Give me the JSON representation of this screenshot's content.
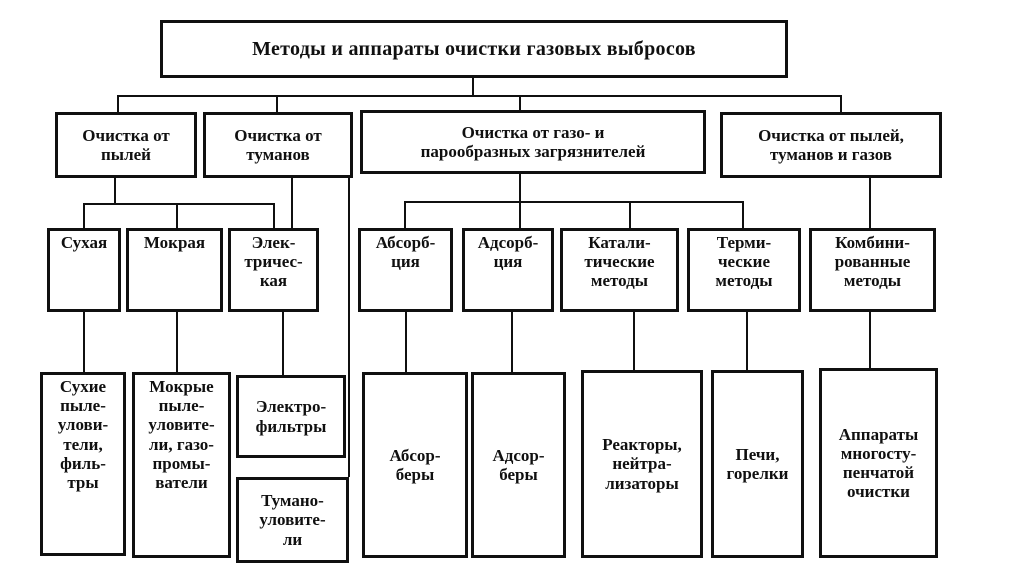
{
  "colors": {
    "ink": "#101010",
    "background": "#ffffff"
  },
  "nodes": {
    "root": {
      "label": "Методы и аппараты очистки газовых выбросов"
    },
    "dust": {
      "label": "Очистка от\nпылей"
    },
    "fog": {
      "label": "Очистка от\nтуманов"
    },
    "gas_vapor": {
      "label": "Очистка от газо- и\nпарообразных загрязнителей"
    },
    "dust_fog_gas": {
      "label": "Очистка от пылей,\nтуманов и газов"
    },
    "dry": {
      "label": "Сухая"
    },
    "wet": {
      "label": "Мокрая"
    },
    "electric": {
      "label": "Элек-\nтричес-\nкая"
    },
    "absorption": {
      "label": "Абсорб-\nция"
    },
    "adsorption": {
      "label": "Адсорб-\nция"
    },
    "catalytic": {
      "label": "Катали-\nтические\nметоды"
    },
    "thermal": {
      "label": "Терми-\nческие\nметоды"
    },
    "combined": {
      "label": "Комбини-\nрованные\nметоды"
    },
    "dry_collectors": {
      "label": "Сухие\nпыле-\nулови-\nтели,\nфиль-\nтры"
    },
    "wet_collectors": {
      "label": "Мокрые\nпыле-\nуловите-\nли, газо-\nпромы-\nватели"
    },
    "electrofilters": {
      "label": "Электро-\nфильтры"
    },
    "mist_collectors": {
      "label": "Тумано-\nуловите-\nли"
    },
    "absorbers": {
      "label": "Абсор-\nберы"
    },
    "adsorbers": {
      "label": "Адсор-\nберы"
    },
    "reactors": {
      "label": "Реакторы,\nнейтра-\nлизаторы"
    },
    "furnaces": {
      "label": "Печи,\nгорелки"
    },
    "multistage": {
      "label": "Аппараты\nмногосту-\nпенчатой\nочистки"
    }
  }
}
